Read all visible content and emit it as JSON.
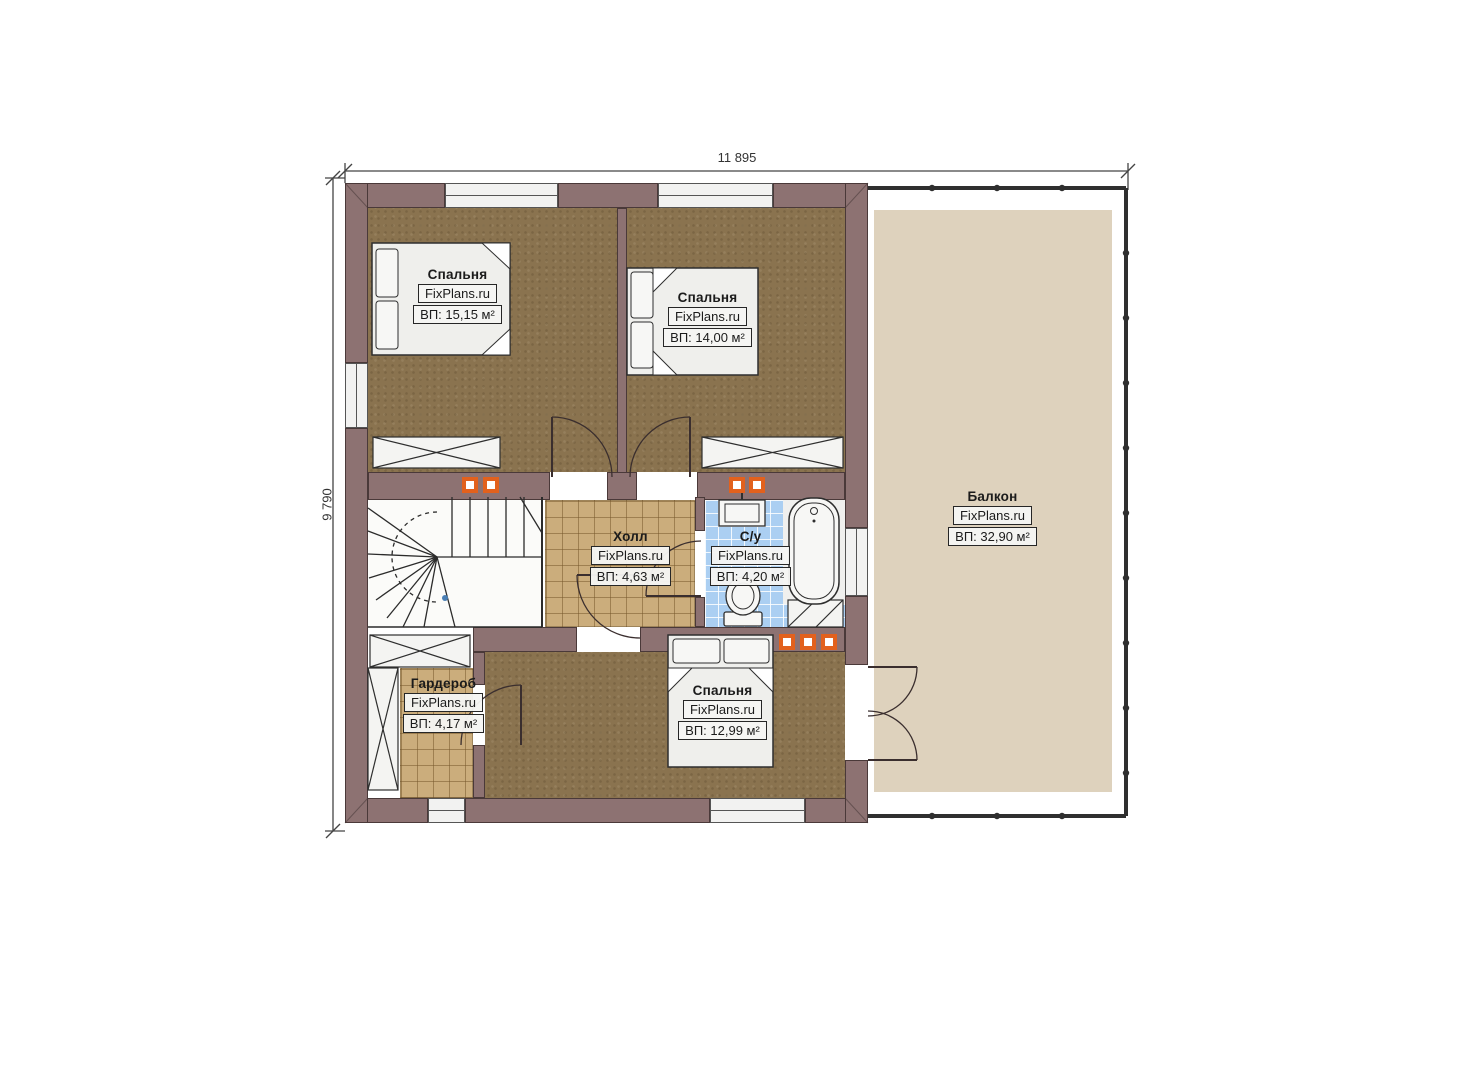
{
  "dimensions": {
    "width_mm": "11 895",
    "height_mm": "9 790"
  },
  "watermark": "FixPlans.ru",
  "rooms": [
    {
      "name": "Спальня",
      "watermark": "FixPlans.ru",
      "area": "ВП: 15,15 м²"
    },
    {
      "name": "Спальня",
      "watermark": "FixPlans.ru",
      "area": "ВП: 14,00 м²"
    },
    {
      "name": "Холл",
      "watermark": "FixPlans.ru",
      "area": "ВП: 4,63 м²"
    },
    {
      "name": "С/у",
      "watermark": "FixPlans.ru",
      "area": "ВП: 4,20 м²"
    },
    {
      "name": "Гардероб",
      "watermark": "FixPlans.ru",
      "area": "ВП: 4,17 м²"
    },
    {
      "name": "Спальня",
      "watermark": "FixPlans.ru",
      "area": "ВП: 12,99 м²"
    },
    {
      "name": "Балкон",
      "watermark": "FixPlans.ru",
      "area": "ВП: 32,90 м²"
    }
  ],
  "colors": {
    "wall": "#8d7272",
    "bedroom_floor": "#8a734f",
    "tile_floor": "#cbad7c",
    "bath_floor": "#abcff2",
    "balcony_floor": "#ded2bd",
    "accent_orange": "#e2611d"
  }
}
